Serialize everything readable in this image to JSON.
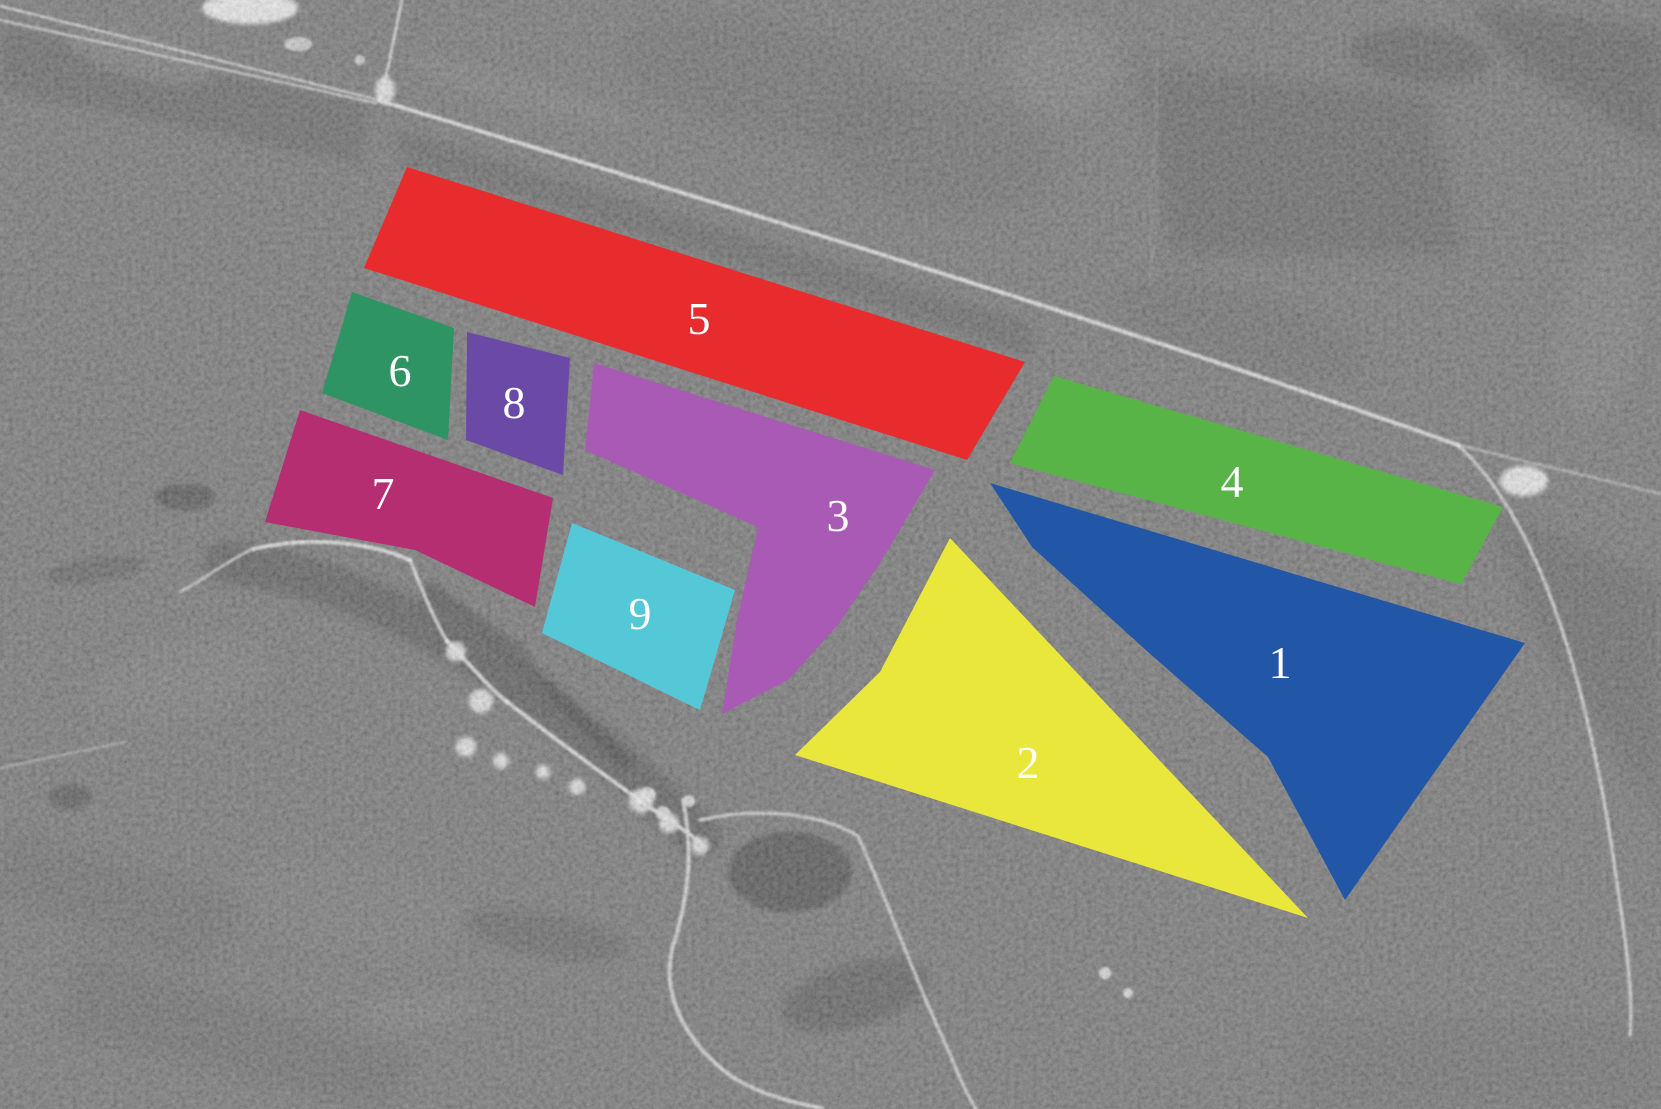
{
  "figure": {
    "kind": "annotated-satellite-image"
  },
  "background": {
    "base_gray": "#575757",
    "road_color": "#f0f0f0",
    "label_text_color": "#ffffff"
  },
  "regions": [
    {
      "id": "1",
      "label": "1",
      "color": "#2257a8",
      "label_x": 1280,
      "label_y": 678,
      "points": [
        [
          990,
          483
        ],
        [
          1525,
          643
        ],
        [
          1345,
          900
        ],
        [
          1268,
          757
        ],
        [
          1148,
          652
        ],
        [
          1032,
          547
        ]
      ]
    },
    {
      "id": "2",
      "label": "2",
      "color": "#eae73c",
      "label_x": 1028,
      "label_y": 778,
      "points": [
        [
          950,
          538
        ],
        [
          1308,
          918
        ],
        [
          795,
          755
        ],
        [
          880,
          672
        ]
      ]
    },
    {
      "id": "3",
      "label": "3",
      "color": "#a95ab4",
      "label_x": 838,
      "label_y": 531,
      "points": [
        [
          594,
          363
        ],
        [
          935,
          470
        ],
        [
          885,
          555
        ],
        [
          838,
          625
        ],
        [
          788,
          680
        ],
        [
          722,
          714
        ],
        [
          737,
          620
        ],
        [
          758,
          527
        ],
        [
          585,
          450
        ]
      ]
    },
    {
      "id": "4",
      "label": "4",
      "color": "#58b447",
      "label_x": 1232,
      "label_y": 497,
      "points": [
        [
          1054,
          376
        ],
        [
          1503,
          507
        ],
        [
          1461,
          584
        ],
        [
          1010,
          463
        ]
      ]
    },
    {
      "id": "5",
      "label": "5",
      "color": "#e82c2e",
      "label_x": 699,
      "label_y": 334,
      "points": [
        [
          407,
          167
        ],
        [
          1025,
          362
        ],
        [
          967,
          460
        ],
        [
          364,
          268
        ]
      ]
    },
    {
      "id": "6",
      "label": "6",
      "color": "#2f9464",
      "label_x": 400,
      "label_y": 386,
      "points": [
        [
          352,
          292
        ],
        [
          454,
          328
        ],
        [
          448,
          440
        ],
        [
          322,
          393
        ]
      ]
    },
    {
      "id": "7",
      "label": "7",
      "color": "#b52e72",
      "label_x": 383,
      "label_y": 509,
      "points": [
        [
          300,
          410
        ],
        [
          553,
          498
        ],
        [
          535,
          607
        ],
        [
          415,
          550
        ],
        [
          265,
          522
        ]
      ]
    },
    {
      "id": "8",
      "label": "8",
      "color": "#6a4aa6",
      "label_x": 514,
      "label_y": 418,
      "points": [
        [
          467,
          332
        ],
        [
          570,
          358
        ],
        [
          563,
          475
        ],
        [
          466,
          440
        ]
      ]
    },
    {
      "id": "9",
      "label": "9",
      "color": "#55c8d8",
      "label_x": 640,
      "label_y": 629,
      "points": [
        [
          572,
          523
        ],
        [
          735,
          590
        ],
        [
          700,
          710
        ],
        [
          542,
          633
        ]
      ]
    }
  ]
}
